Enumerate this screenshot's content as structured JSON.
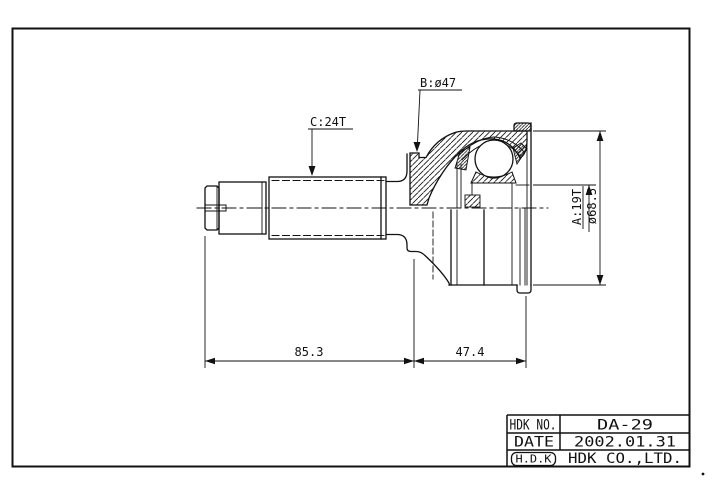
{
  "drawing": {
    "labels": {
      "spline_b": "B:ø47",
      "spline_c": "C:24T",
      "spline_a": "A:19T",
      "outer_diameter": "ø68.5",
      "length_shaft": "85.3",
      "length_joint": "47.4"
    },
    "title_block": {
      "rows": [
        {
          "label": "HDK NO.",
          "value": "DA-29"
        },
        {
          "label": "DATE",
          "value": "2002.01.31"
        },
        {
          "label": "H.D.K",
          "value": "HDK CO.,LTD."
        }
      ]
    },
    "line_color": "#111111",
    "background": "#ffffff"
  }
}
